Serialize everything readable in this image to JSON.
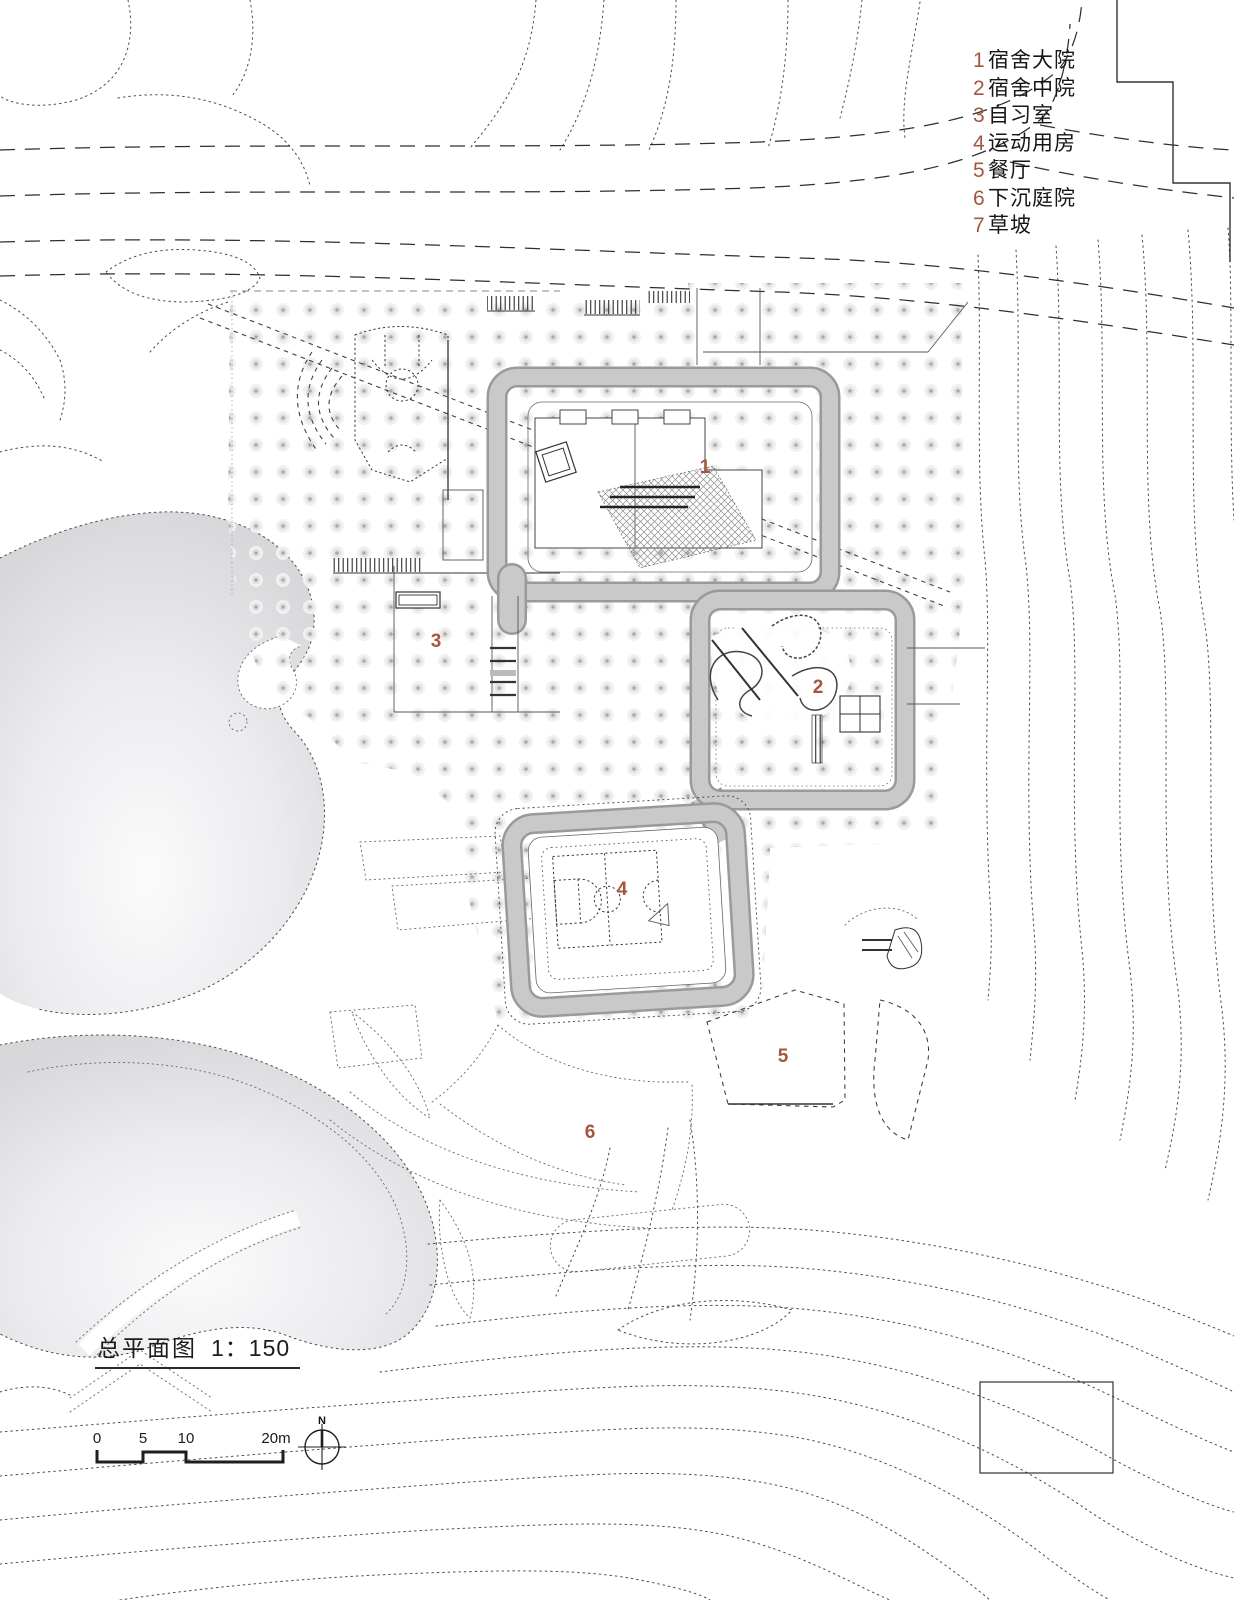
{
  "drawing": {
    "title": "总平面图",
    "scale": "1：150",
    "north_label": "N",
    "legend": [
      {
        "num": "1",
        "label": "宿舍大院"
      },
      {
        "num": "2",
        "label": "宿舍中院"
      },
      {
        "num": "3",
        "label": "自习室"
      },
      {
        "num": "4",
        "label": "运动用房"
      },
      {
        "num": "5",
        "label": "餐厅"
      },
      {
        "num": "6",
        "label": "下沉庭院"
      },
      {
        "num": "7",
        "label": "草坡"
      }
    ],
    "scale_bar": {
      "ticks": [
        "0",
        "5",
        "10",
        "20m"
      ]
    },
    "plan_labels": [
      {
        "num": "1",
        "x": 705,
        "y": 468
      },
      {
        "num": "2",
        "x": 818,
        "y": 688
      },
      {
        "num": "3",
        "x": 436,
        "y": 642
      },
      {
        "num": "4",
        "x": 622,
        "y": 890
      },
      {
        "num": "5",
        "x": 783,
        "y": 1057
      },
      {
        "num": "6",
        "x": 590,
        "y": 1133
      }
    ],
    "colors": {
      "label_number": "#a3573e",
      "wall_band": "#c9c9c9",
      "wall_rim": "#9a9a9a",
      "contour_line": "#4a4a4a",
      "mound_shade": "#d7d7da"
    }
  }
}
